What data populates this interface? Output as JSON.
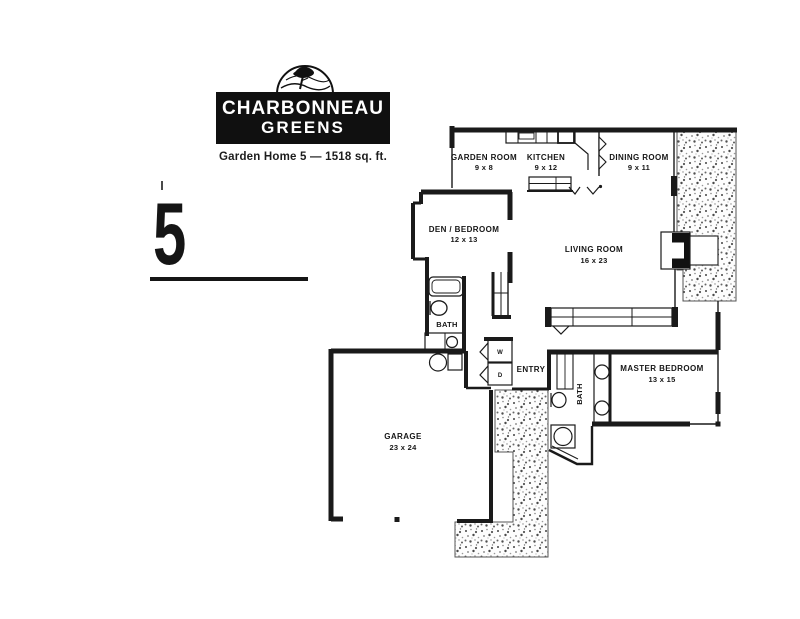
{
  "logo": {
    "line1": "CHARBONNEAU",
    "line2": "GREENS",
    "emblem": "hills-and-tree-icon",
    "bg_color": "#101010",
    "text_color": "#ffffff"
  },
  "subtitle": "Garden Home 5 — 1518 sq. ft.",
  "plan_number": "5",
  "floor_plan": {
    "ink_color": "#161616",
    "rooms": {
      "garden_room": {
        "label": "GARDEN ROOM",
        "dims": "9 x 8"
      },
      "kitchen": {
        "label": "KITCHEN",
        "dims": "9 x 12"
      },
      "dining_room": {
        "label": "DINING ROOM",
        "dims": "9 x 11"
      },
      "den_bedroom": {
        "label": "DEN / BEDROOM",
        "dims": "12 x 13"
      },
      "living_room": {
        "label": "LIVING ROOM",
        "dims": "16 x 23"
      },
      "bath": {
        "label": "BATH"
      },
      "entry": {
        "label": "ENTRY"
      },
      "master_bath": {
        "label": "BATH"
      },
      "master_bedroom": {
        "label": "MASTER BEDROOM",
        "dims": "13 x 15"
      },
      "garage": {
        "label": "GARAGE",
        "dims": "23 x 24"
      }
    },
    "appliances": {
      "washer": "W",
      "dryer": "D"
    }
  }
}
